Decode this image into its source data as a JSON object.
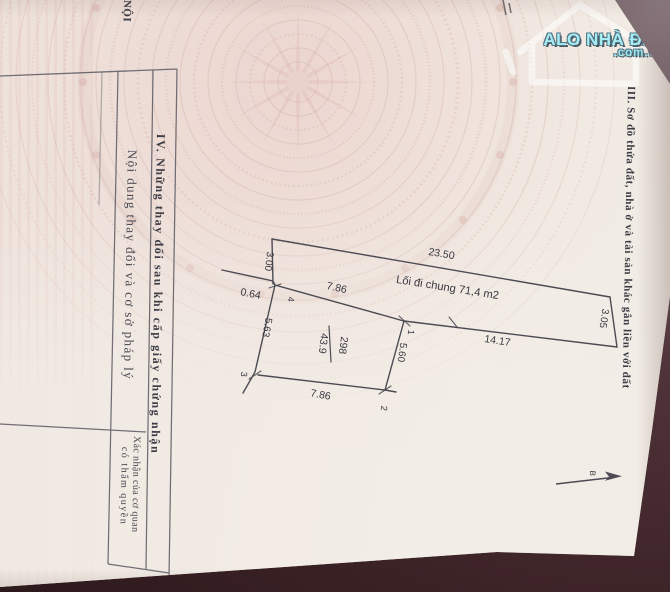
{
  "watermark": {
    "brand": "ALO NHÀ ĐẤT",
    "domain": ".com.vn"
  },
  "margin_note": "NỘI",
  "section3": {
    "title": "III. Sơ đồ thửa đất, nhà ở và tài sản khác gắn liền với đất"
  },
  "section4": {
    "title": "IV. Những thay đổi sau khi cấp giấy chứng nhận",
    "left_column_header": "Nội dung thay đổi và cơ sở pháp lý",
    "right_column_header_line1": "Xác nhận của cơ quan",
    "right_column_header_line2": "có thẩm quyền"
  },
  "diagram": {
    "parcel_number": "298",
    "parcel_area": "43.9",
    "path_label": "Lối đi chung 71,4 m2",
    "dim_path_top": "23.50",
    "dim_path_right": "3.05",
    "dim_path_bottom": "14.17",
    "dim_plot_top": "7.86",
    "dim_plot_right": "5.60",
    "dim_plot_bottom": "7.86",
    "dim_plot_left": "5.63",
    "dim_left_width": "3.00",
    "dim_offset": "0.64",
    "corner_1": "1",
    "corner_2": "2",
    "corner_3": "3",
    "corner_4": "4",
    "north_label": "B"
  },
  "colors": {
    "paper": "#f1ece4",
    "emblem_pink": "#d8b7af",
    "drawing_line": "#4c4b54",
    "ink": "#3a3a43",
    "watermark_cyan": "#9fe8f0",
    "surface_dark": "#3a2124"
  }
}
